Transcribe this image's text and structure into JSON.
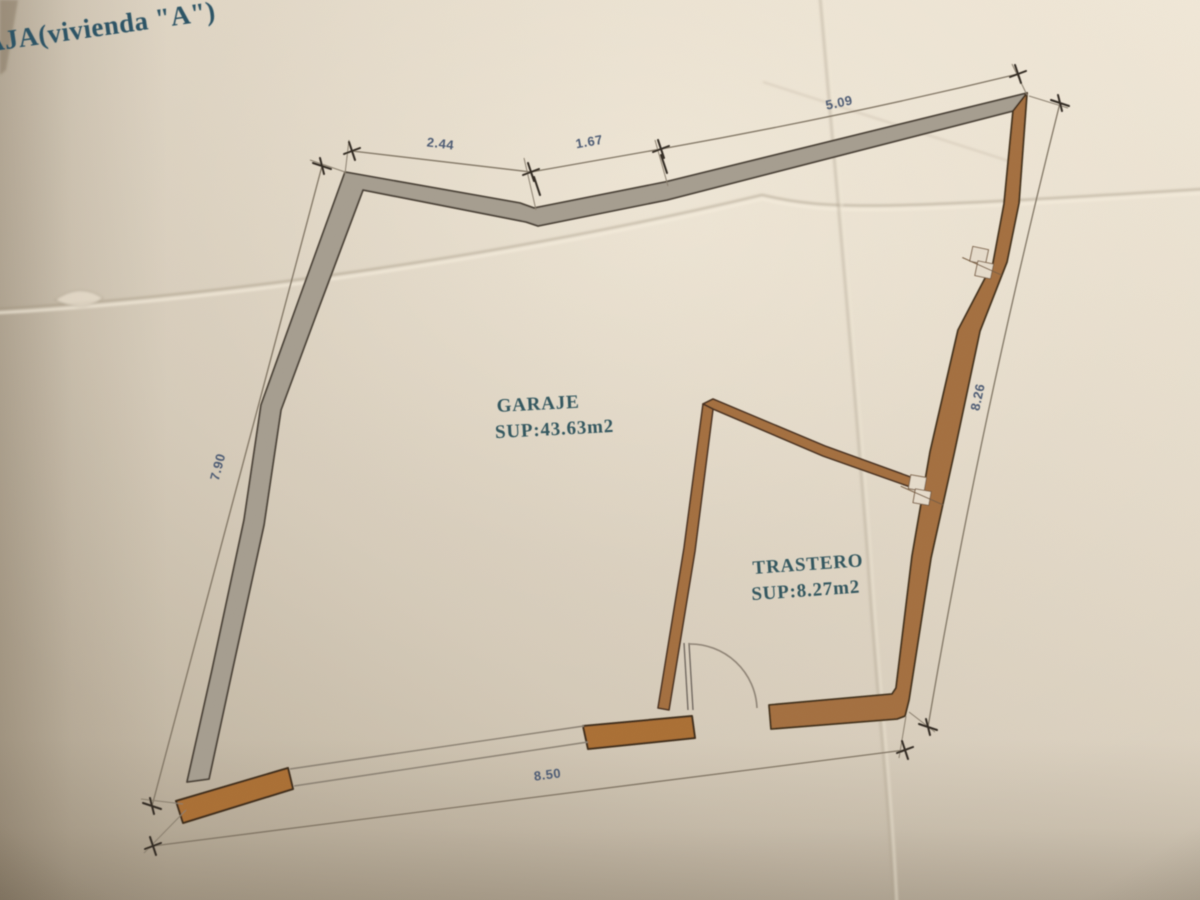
{
  "plan": {
    "title": "AJA(vivienda \"A\")",
    "rooms": [
      {
        "name": "GARAJE",
        "area": "SUP:43.63m2"
      },
      {
        "name": "TRASTERO",
        "area": "SUP:8.27m2"
      }
    ],
    "dimensions": {
      "top_left": "2.44",
      "top_mid": "1.67",
      "top_right": "5.09",
      "left": "7.90",
      "right": "8.26",
      "bottom": "8.50"
    },
    "colors": {
      "wall_gray": "#a69e90",
      "wall_brown": "#a4703f",
      "label_teal": "#33565f",
      "title_teal": "#2b5265",
      "dimension_text": "#4d5c74",
      "paper_light": "#ece3d3",
      "paper_dark": "#bfb4a1"
    }
  }
}
